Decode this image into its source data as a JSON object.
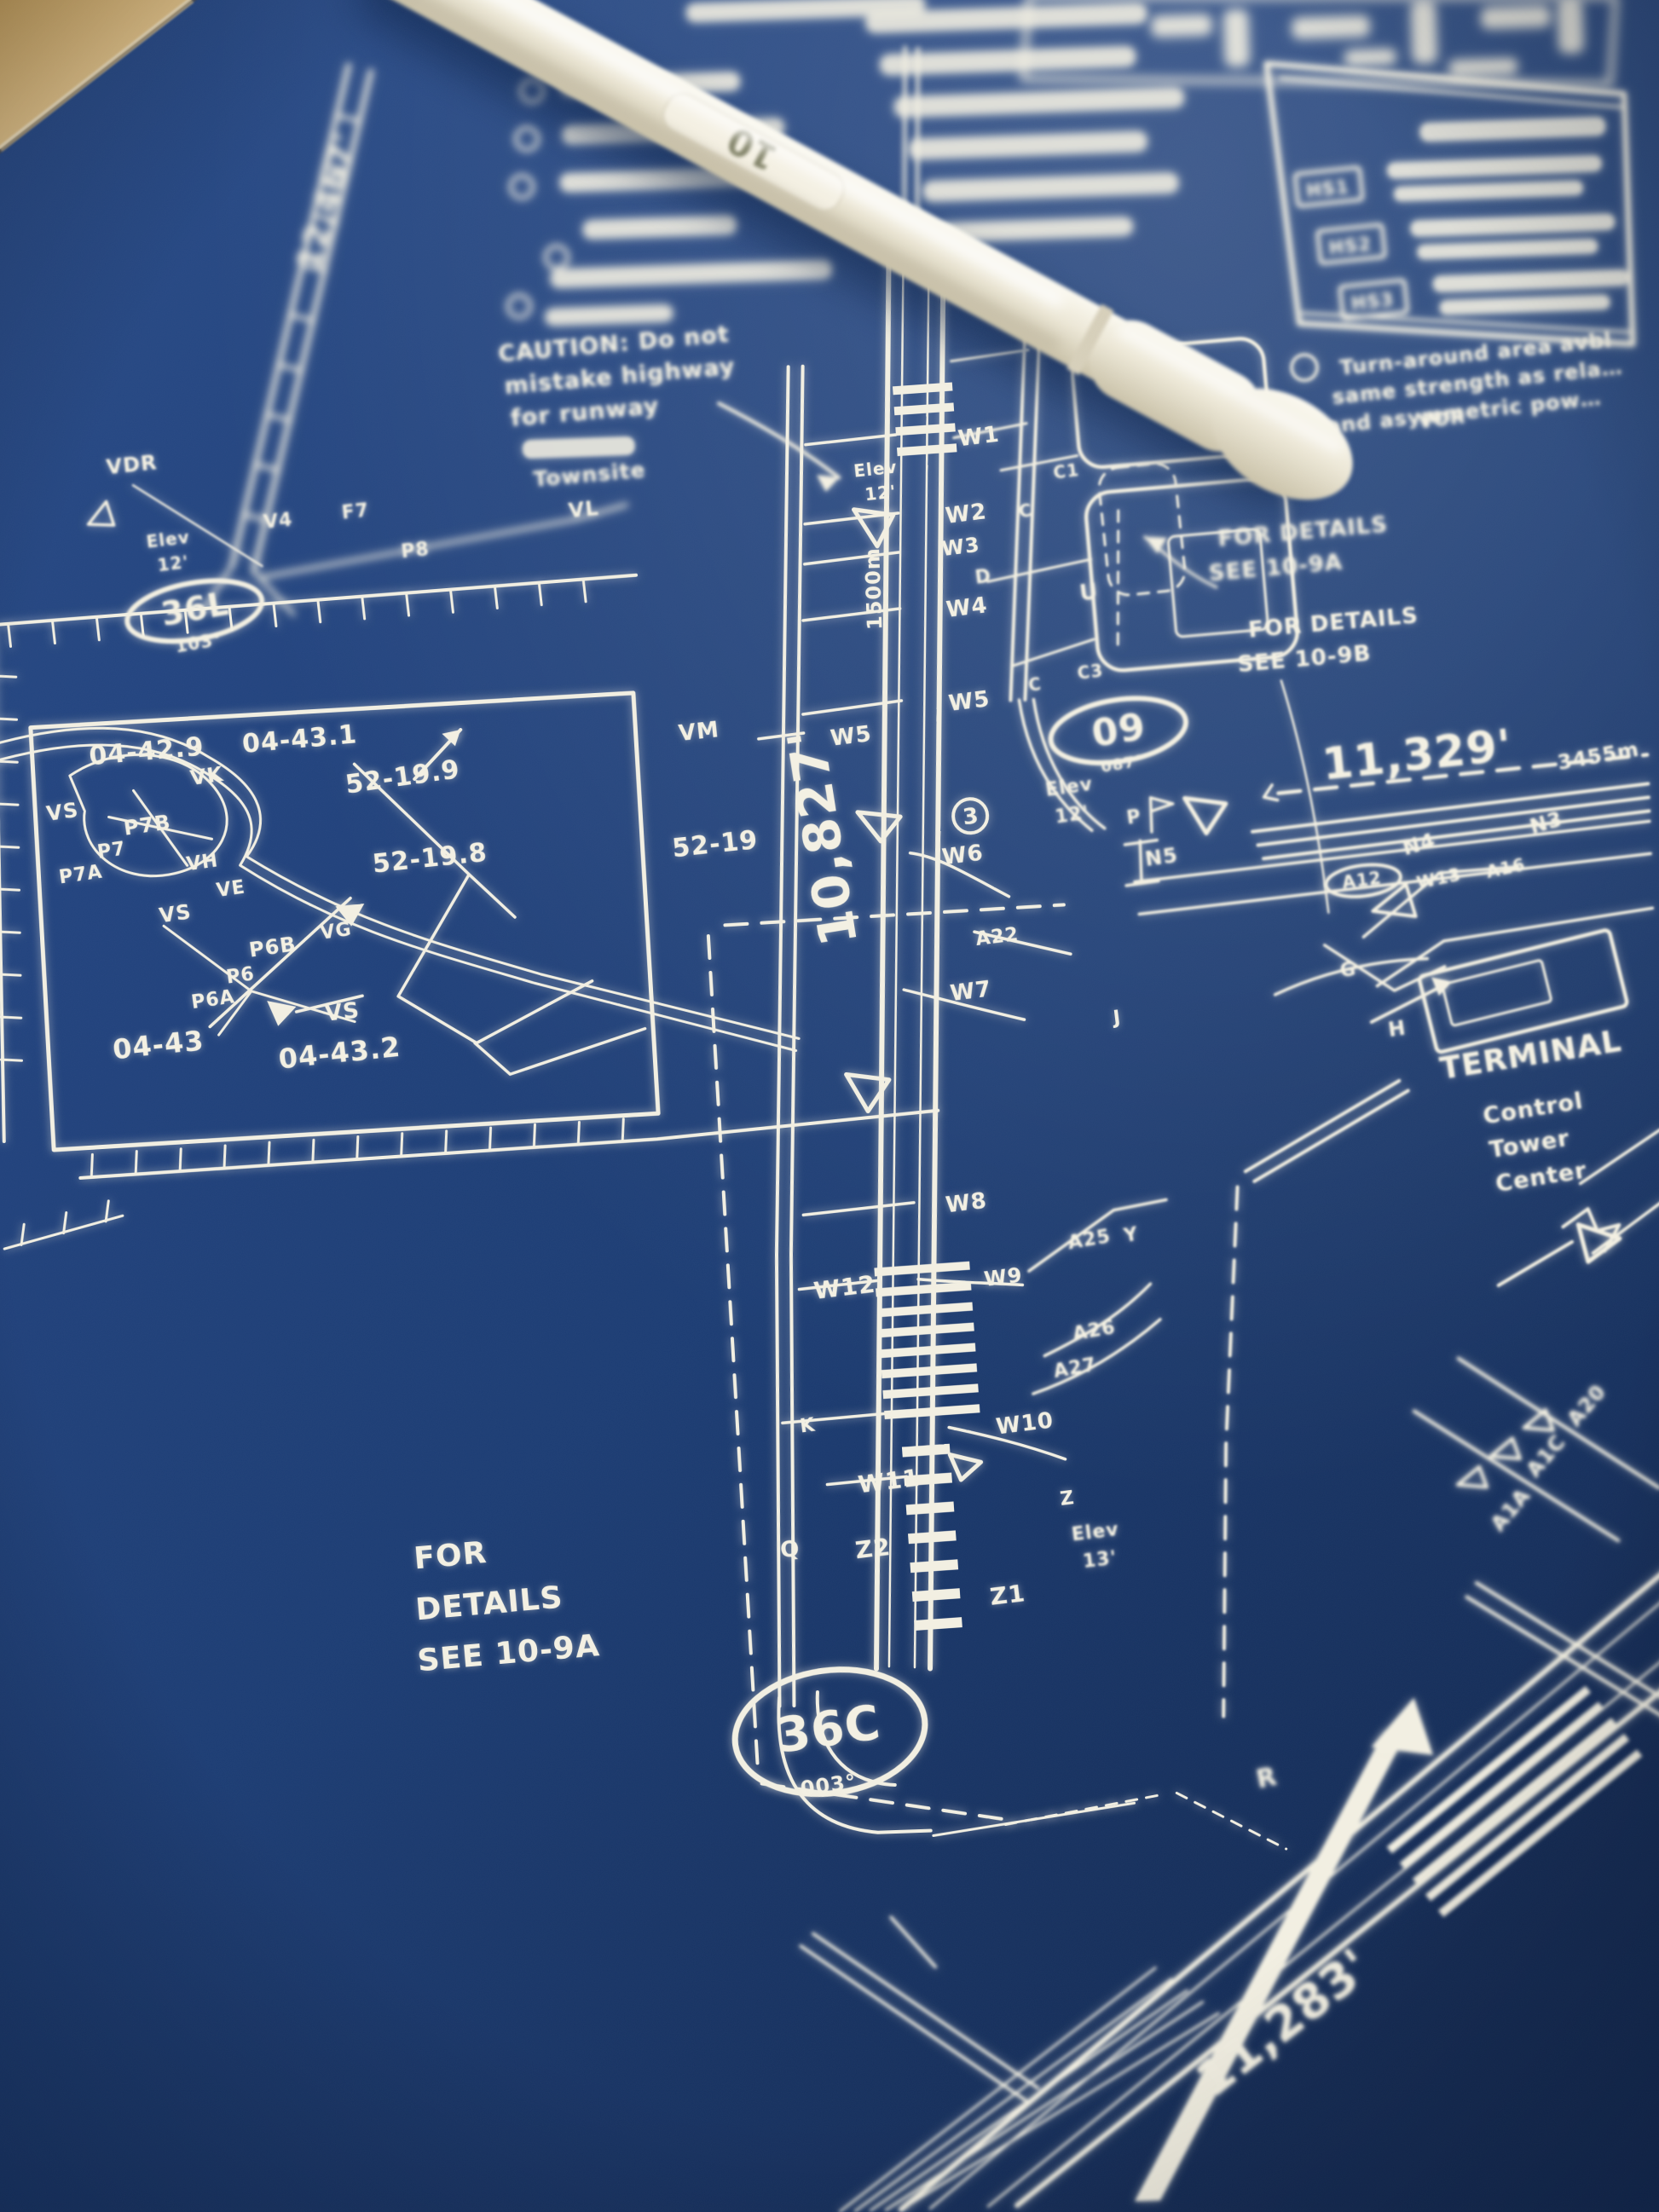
{
  "photo": {
    "pen": {
      "barrel_number": "10"
    }
  },
  "map": {
    "runways": {
      "nw": {
        "length": "12,467'"
      },
      "r36l": {
        "id": "36L",
        "heading": "103°"
      },
      "r36c": {
        "id": "36C",
        "heading": "003°",
        "length": "10,827'",
        "marker": "1500m"
      },
      "r09": {
        "id": "09",
        "heading": "087°",
        "length": "11,329'",
        "metric": "3455m"
      },
      "se": {
        "length": "11,283'"
      }
    },
    "elevations": {
      "nw": {
        "l1": "Elev",
        "l2": "12'"
      },
      "mid": {
        "l1": "Elev",
        "l2": "12'"
      },
      "east": {
        "l1": "Elev",
        "l2": "12'"
      },
      "south": {
        "l1": "Elev",
        "l2": "13'"
      }
    },
    "grid": {
      "g1": "04-42.9",
      "g2": "04-43.1",
      "g3": "52-19.9",
      "g4": "52-19.8",
      "g5": "52-19",
      "g6": "04-43",
      "g7": "04-43.2"
    },
    "hotspots": {
      "h1": "HS1",
      "h2": "HS2",
      "h3": "HS3"
    },
    "symbols": {
      "circled3": "3"
    },
    "notes": {
      "vdr": "VDR",
      "vor": "VOR",
      "terminal": "TERMINAL",
      "control_tower": {
        "l1": "Control",
        "l2": "Tower",
        "l3": "Center"
      },
      "caution": {
        "l1": "CAUTION: Do not",
        "l2": "mistake highway",
        "l3": "for runway"
      },
      "townsite": "Townsite",
      "details_left": {
        "l1": "FOR",
        "l2": "DETAILS",
        "l3": "SEE 10-9A"
      },
      "details_right_a": {
        "l1": "FOR DETAILS",
        "l2": "SEE 10-9A"
      },
      "details_right_b": {
        "l1": "FOR DETAILS",
        "l2": "SEE 10-9B"
      },
      "turn_around": {
        "l1": "Turn-around area avbl",
        "l2": "same strength as rela…",
        "l3": "and asymmetric pow…"
      }
    },
    "taxiways": {
      "v4": "V4",
      "f7": "F7",
      "vl": "VL",
      "p8": "P8",
      "vm": "VM",
      "vk": "VK",
      "vs1": "VS",
      "vs2": "VS",
      "vs3": "VS",
      "p7b": "P7B",
      "p7": "P7",
      "p7a": "P7A",
      "vh": "VH",
      "ve": "VE",
      "vg": "VG",
      "p6b": "P6B",
      "p6": "P6",
      "p6a": "P6A",
      "w1": "W1",
      "w2": "W2",
      "w3": "W3",
      "w4": "W4",
      "w5a": "W5",
      "w5b": "W5",
      "w6": "W6",
      "w7": "W7",
      "w8": "W8",
      "w9": "W9",
      "w10": "W10",
      "w11": "W11",
      "w12": "W12",
      "w13": "W13",
      "a22": "A22",
      "a25": "A25",
      "a26": "A26",
      "a27": "A27",
      "y": "Y",
      "k": "K",
      "q": "Q",
      "z": "Z",
      "z1": "Z1",
      "z2": "Z2",
      "c1": "C1",
      "ca": "C",
      "c3": "C3",
      "cb": "C",
      "d": "D",
      "u": "U",
      "n3": "N3",
      "n4": "N4",
      "n5": "N5",
      "a12": "A12",
      "a16": "A16",
      "g": "G",
      "h": "H",
      "j": "J",
      "p": "P",
      "r": "R",
      "a20": "A20",
      "a1c": "A1C",
      "a1a": "A1A"
    }
  }
}
